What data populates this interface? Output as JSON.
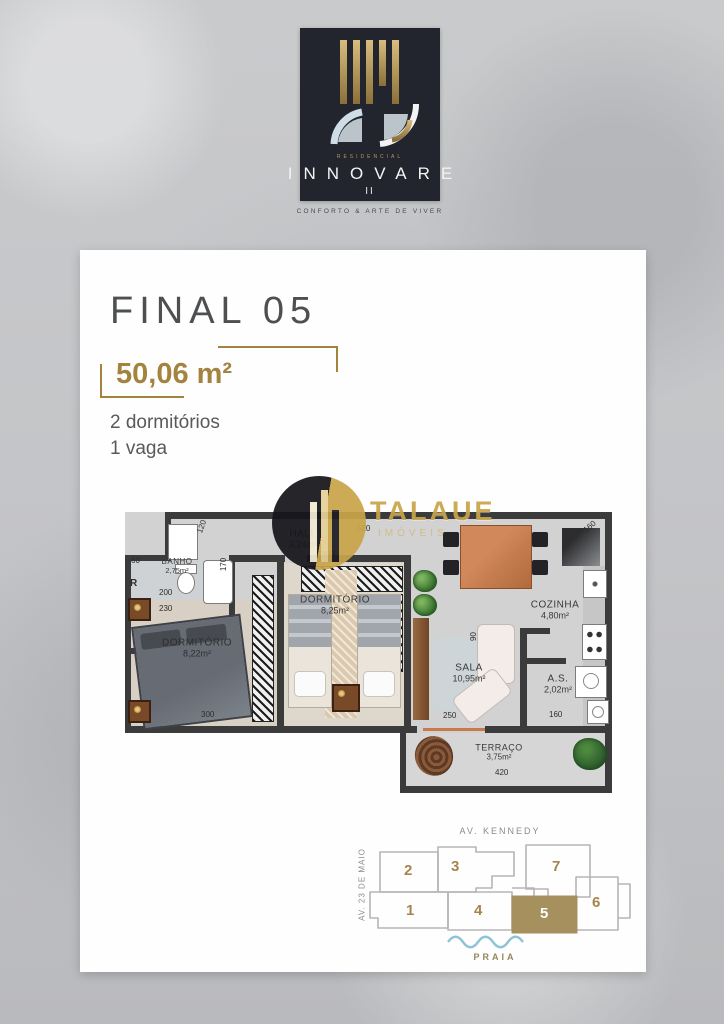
{
  "logo": {
    "residencial": "RESIDENCIAL",
    "name": "INNOVARE",
    "numeral": "II",
    "tagline": "CONFORTO & ARTE DE VIVER"
  },
  "unit": {
    "title": "FINAL 05",
    "area": "50,06 m²",
    "spec_line1": "2 dormitórios",
    "spec_line2": "1 vaga"
  },
  "watermark": {
    "name": "TALAUE",
    "sub": "IMÓVEIS"
  },
  "floorplan": {
    "rooms": [
      {
        "name": "BANHO",
        "area": "2,75m²"
      },
      {
        "name": "HALL",
        "area": "3,24m²"
      },
      {
        "name": "DORMITÓRIO",
        "area": "8,25m²"
      },
      {
        "name": "DORMITÓRIO",
        "area": "8,22m²"
      },
      {
        "name": "SALA",
        "area": "10,95m²"
      },
      {
        "name": "COZINHA",
        "area": "4,80m²"
      },
      {
        "name": "A.S.",
        "area": "2,02m²"
      },
      {
        "name": "TERRAÇO",
        "area": "3,75m²"
      }
    ],
    "dims": [
      "120",
      "60",
      "170",
      "200",
      "230",
      "300",
      "360",
      "520",
      "160",
      "160",
      "250",
      "420",
      "R",
      "90"
    ]
  },
  "siteplan": {
    "street_top": "AV. KENNEDY",
    "street_left": "AV. 23 DE MAIO",
    "beach_label": "PRAIA",
    "units": [
      "1",
      "2",
      "3",
      "4",
      "5",
      "6",
      "7"
    ],
    "highlighted_unit": "5"
  },
  "colors": {
    "accent_gold": "#a3833e",
    "highlight_unit": "#a6915e",
    "wall": "#3b3b3b",
    "wave_blue": "#8ec4d6",
    "logo_bg": "#23252e"
  }
}
